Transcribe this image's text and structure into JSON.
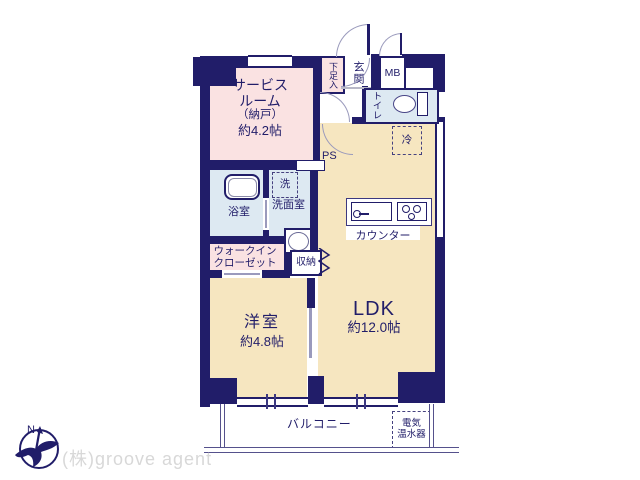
{
  "plan": {
    "rooms": {
      "service_room": {
        "line1": "サービス",
        "line2": "ルーム",
        "line3": "（納戸）",
        "line4": "約4.2帖"
      },
      "ldk": {
        "name": "LDK",
        "size": "約12.0帖"
      },
      "western_room": {
        "name": "洋室",
        "size": "約4.8帖"
      },
      "bath": {
        "label": "浴室"
      },
      "washroom": {
        "label": "洗面室"
      },
      "toilet": {
        "label": "トイレ"
      },
      "walk_in_closet": {
        "line1": "ウォークイン",
        "line2": "クローゼット"
      },
      "storage": {
        "label": "収納"
      },
      "entrance": {
        "label": "玄関"
      },
      "shoe_box": {
        "label": "下足入"
      },
      "meter_box": {
        "label": "MB"
      },
      "pipe_space": {
        "label": "PS"
      },
      "laundry": {
        "label": "洗"
      },
      "refrigerator": {
        "label": "冷"
      },
      "counter": {
        "label": "カウンター"
      },
      "balcony": {
        "label": "バルコニー"
      },
      "water_heater": {
        "line1": "電気",
        "line2": "温水器"
      }
    },
    "colors": {
      "wall_navy": "#211d69",
      "room_pink": "#fae2e2",
      "room_cream": "#f6e6c0",
      "room_blue": "#dde9f2",
      "door_arc_gray": "#9a9abc",
      "logo_text_gray": "#d8d8d8"
    }
  },
  "footer": {
    "company": "(株)groove agent",
    "compass_letter": "N"
  }
}
